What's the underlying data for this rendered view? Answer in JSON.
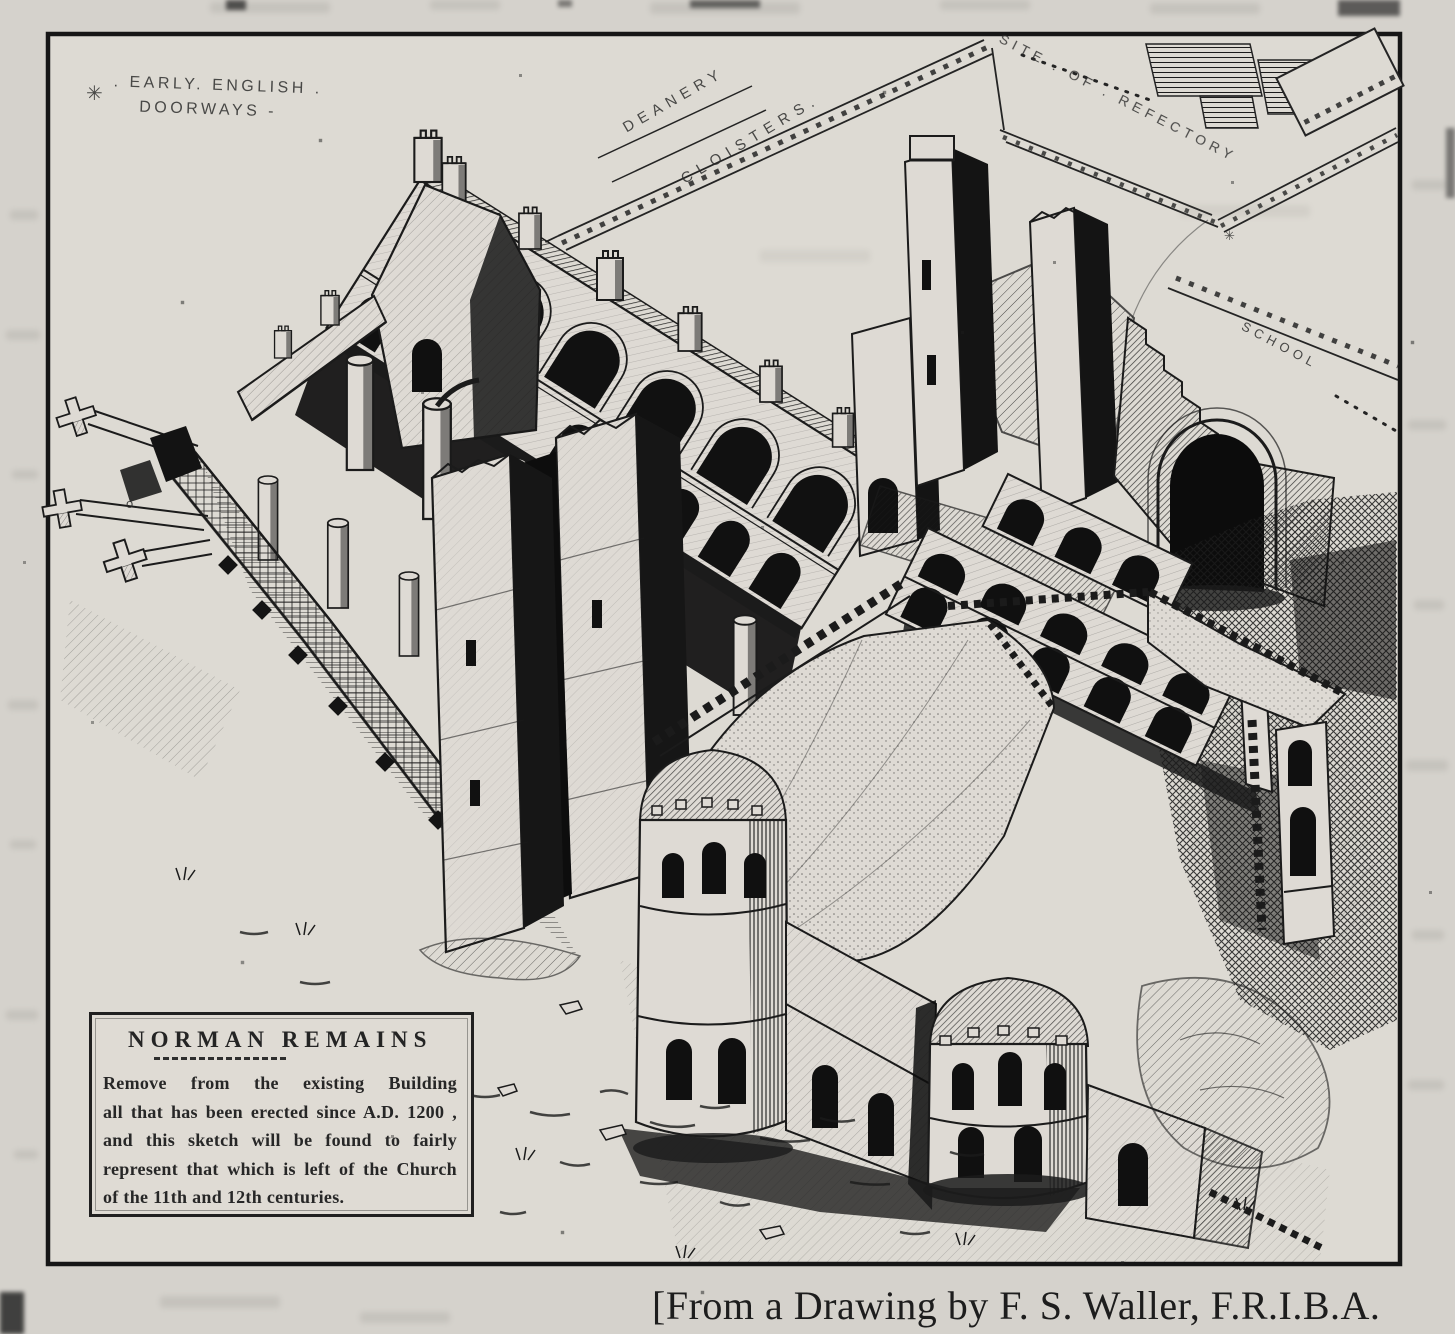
{
  "colors": {
    "paper": "#d5d2cc",
    "paper_light": "#dedad4",
    "ink": "#1b1b1b"
  },
  "illustration": {
    "plan_labels": {
      "early_english_marker": "✳",
      "early_english_line1": ". EARLY. ENGLISH .",
      "early_english_line2": "DOORWAYS -",
      "deanery": "DEANERY",
      "cloisters": "CLOISTERS.",
      "site_of_refectory": "SITE . OF . REFECTORY",
      "school": "SCHOOL",
      "plan_mark": "✳",
      "ground_mark": "o."
    },
    "legend_box": {
      "title": "NORMAN REMAINS",
      "lines": [
        "Remove from the existing Building",
        "all that has been erected since A.D. 1200 ,",
        "and this sketch will be found to fairly",
        "represent that which is left of the Church",
        "of the 11th and 12th centuries."
      ]
    }
  },
  "caption": "[From a Drawing by F. S. Waller, F.R.I.B.A."
}
